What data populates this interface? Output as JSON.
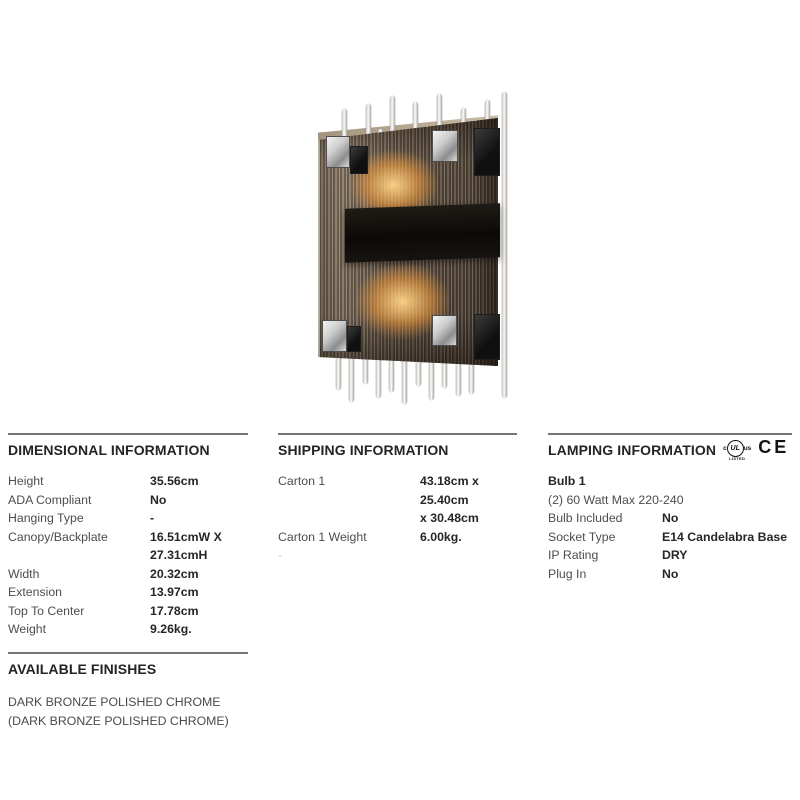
{
  "certification": {
    "c": "c",
    "ul": "UL",
    "us": "us",
    "listed": "LISTED",
    "ce": "CE"
  },
  "sections": {
    "dimensional": {
      "title": "DIMENSIONAL INFORMATION",
      "rows": [
        {
          "label": "Height",
          "value": "35.56cm"
        },
        {
          "label": "ADA Compliant",
          "value": "No"
        },
        {
          "label": "Hanging Type",
          "value": "-"
        },
        {
          "label": "Canopy/Backplate",
          "value": "16.51cmW X\n27.31cmH"
        },
        {
          "label": "Width",
          "value": "20.32cm"
        },
        {
          "label": "Extension",
          "value": "13.97cm"
        },
        {
          "label": "Top To Center",
          "value": "17.78cm"
        },
        {
          "label": "Weight",
          "value": "9.26kg."
        }
      ]
    },
    "shipping": {
      "title": "SHIPPING INFORMATION",
      "rows": [
        {
          "label": "Carton 1",
          "value": "43.18cm x 25.40cm\nx 30.48cm"
        },
        {
          "label": "Carton 1 Weight",
          "value": "6.00kg."
        },
        {
          "label": "-",
          "value": ""
        }
      ]
    },
    "lamping": {
      "title": "LAMPING INFORMATION",
      "bulb_heading": "Bulb 1",
      "bulb_description": "(2) 60 Watt Max 220-240",
      "rows": [
        {
          "label": "Bulb Included",
          "value": "No"
        },
        {
          "label": "Socket Type",
          "value": "E14 Candelabra Base"
        },
        {
          "label": "IP Rating",
          "value": "DRY"
        },
        {
          "label": "Plug In",
          "value": "No"
        }
      ]
    },
    "finishes": {
      "title": "AVAILABLE FINISHES",
      "text": "DARK BRONZE POLISHED CHROME (DARK BRONZE POLISHED CHROME)"
    }
  },
  "product": {
    "description": "Two-light wall sconce with smoked bronze glass panel, clear glass rods and polished chrome clips"
  },
  "colors": {
    "rule": "#757575",
    "heading": "#222426",
    "label": "#4d4d4d",
    "value": "#262626",
    "glow": "#e99a3e",
    "smoke_glass": "#625242",
    "chrome": "#cccccc"
  }
}
